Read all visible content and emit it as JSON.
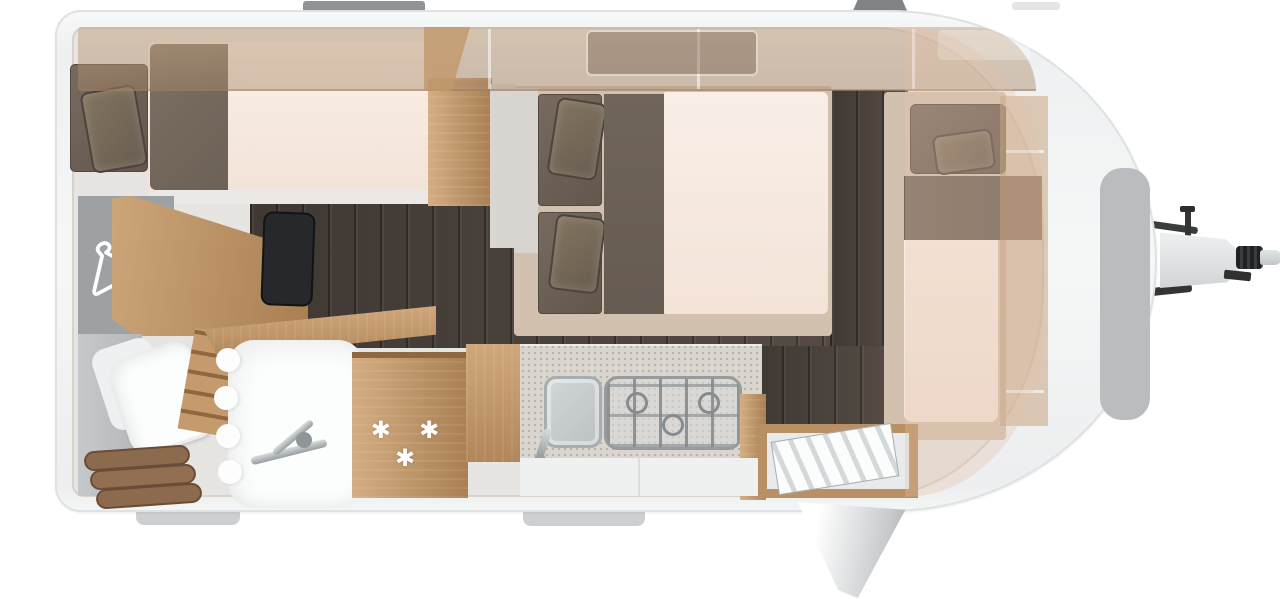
{
  "scene": {
    "description": "Top-down floor plan of a single-axle travel caravan",
    "fridge_symbol": "✱ ✱ ✱"
  },
  "colors": {
    "shell": "#f5f6f7",
    "interior": "#e7e5e2",
    "wood_light": "#d0a77b",
    "wood_dark": "#a97f53",
    "dark_floor": "#463e38",
    "mattress_cream": "#f8ece3",
    "cushion_taupe": "#6e6258",
    "counter_speckle": "#dad6cf",
    "appliance_chrome": "#aab0b3",
    "tv_black": "#26282b",
    "step_cushion_brown": "#8c6a4e",
    "exterior_fitting_gray": "#8f9395",
    "gas_locker_gray": "#b9bdbf"
  },
  "icons": {
    "wardrobe": "clothes-hanger-icon",
    "fridge": "snowflake-asterisk-icons"
  },
  "components": [
    "rear single bed with pillows",
    "wardrobe with hanger symbol",
    "flat-screen TV",
    "washroom with swivel toilet",
    "corner washbasin with shower curtain and mixer tap",
    "padded step cushions",
    "ladder steps",
    "refrigerator",
    "kitchen block with sink and 3-burner hob",
    "central double bed",
    "front single bed",
    "front wardrobe",
    "entry door shown open",
    "overhead lockers (translucent)",
    "roof skylight",
    "gas locker lid",
    "tow hitch with coupling head and jockey-wheel crank"
  ]
}
